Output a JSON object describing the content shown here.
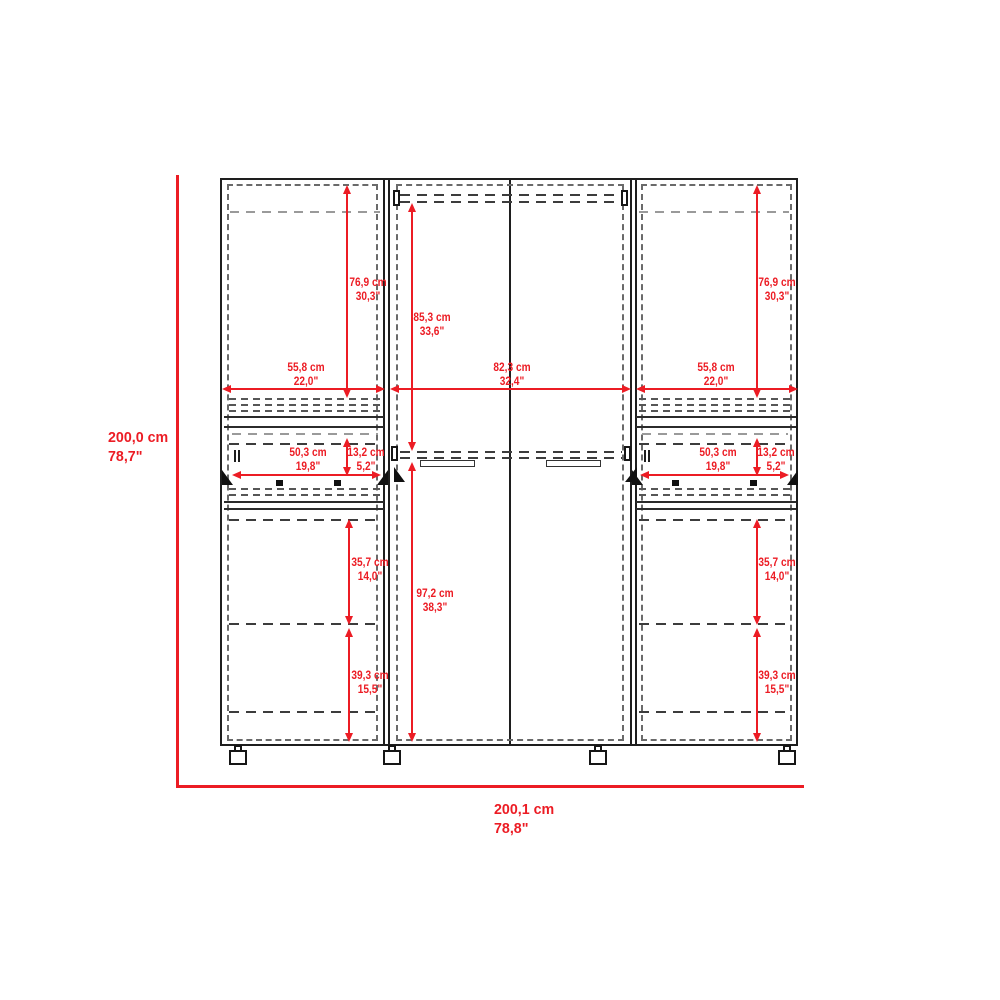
{
  "colors": {
    "dimension_red": "#EC1C24",
    "outline_dark": "#1E1E1E",
    "dash_gray": "#6A6A6A"
  },
  "dims": {
    "total_height": {
      "cm": "200,0 cm",
      "in": "78,7\""
    },
    "total_width": {
      "cm": "200,1 cm",
      "in": "78,8\""
    },
    "door_height": {
      "cm": "76,9 cm",
      "in": "30,3\""
    },
    "side_section_width": {
      "cm": "55,8 cm",
      "in": "22,0\""
    },
    "center_section_width": {
      "cm": "82,3 cm",
      "in": "32,4\""
    },
    "center_upper_height": {
      "cm": "85,3 cm",
      "in": "33,6\""
    },
    "center_lower_height": {
      "cm": "97,2 cm",
      "in": "38,3\""
    },
    "drawer_width": {
      "cm": "50,3 cm",
      "in": "19,8\""
    },
    "drawer_height": {
      "cm": "13,2 cm",
      "in": "5,2\""
    },
    "shelf_gap_upper": {
      "cm": "35,7 cm",
      "in": "14,0\""
    },
    "shelf_gap_lower": {
      "cm": "39,3 cm",
      "in": "15,5\""
    }
  }
}
